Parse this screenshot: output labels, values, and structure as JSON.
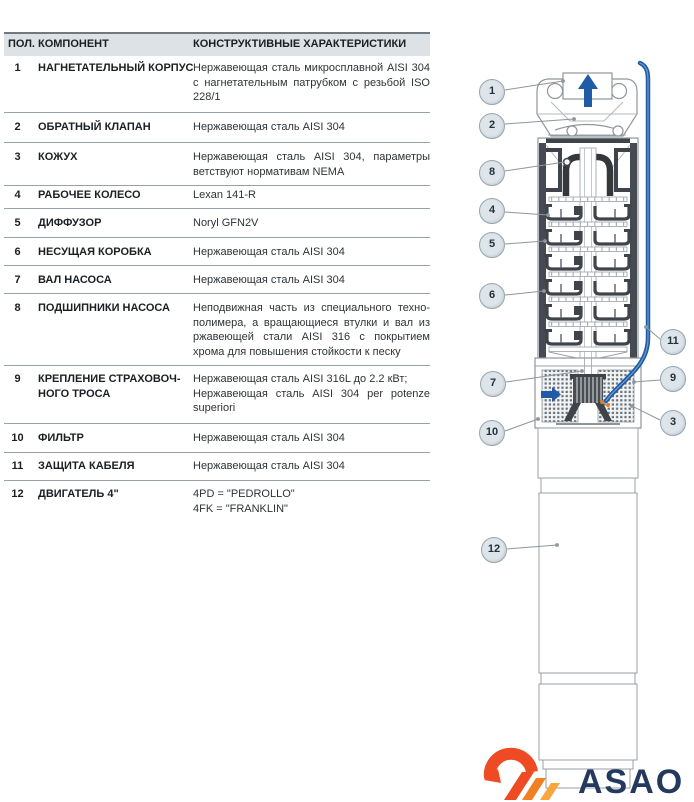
{
  "table": {
    "headers": {
      "pos": "ПОЛ.",
      "component": "КОМПОНЕНТ",
      "characteristics": "КОНСТРУКТИВНЫЕ ХАРАКТЕРИСТИКИ"
    },
    "rows": [
      {
        "num": "1",
        "component_lines": [
          "НАГНЕТАТЕЛЬНЫЙ КОРПУС"
        ],
        "spec_lines": [
          "Нержавеющая сталь микросплавной AISI 304",
          "с нагнетательным патрубком с резьбой ISO",
          "228/1"
        ]
      },
      {
        "num": "2",
        "component_lines": [
          "ОБРАТНЫЙ КЛАПАН"
        ],
        "spec_lines": [
          "Нержавеющая сталь AISI 304"
        ]
      },
      {
        "num": "3",
        "component_lines": [
          "КОЖУХ"
        ],
        "spec_lines": [
          "Нержавеющая сталь AISI 304, параметры соот-",
          "ветствуют нормативам NEMA"
        ]
      },
      {
        "num": "4",
        "component_lines": [
          "РАБОЧЕЕ КОЛЕСО"
        ],
        "spec_lines": [
          "Lexan 141-R"
        ]
      },
      {
        "num": "5",
        "component_lines": [
          "ДИФФУЗОР"
        ],
        "spec_lines": [
          "Noryl GFN2V"
        ]
      },
      {
        "num": "6",
        "component_lines": [
          "НЕСУЩАЯ КОРОБКА"
        ],
        "spec_lines": [
          "Нержавеющая сталь AISI 304"
        ]
      },
      {
        "num": "7",
        "component_lines": [
          "ВАЛ НАСОСА"
        ],
        "spec_lines": [
          "Нержавеющая сталь AISI 304"
        ]
      },
      {
        "num": "8",
        "component_lines": [
          "ПОДШИПНИКИ НАСОСА"
        ],
        "spec_lines": [
          "Неподвижная часть из специального техно-",
          "полимера, а вращающиеся втулки и вал из не-",
          "ржавеющей стали AISI 316 с покрытием окисью",
          "хрома для повышения стойкости к песку"
        ]
      },
      {
        "num": "9",
        "component_lines": [
          "КРЕПЛЕНИЕ СТРАХОВОЧ-",
          "НОГО ТРОСА"
        ],
        "spec_lines": [
          "Нержавеющая сталь AISI 316L до 2.2 кВт;",
          "Нержавеющая сталь AISI 304 per potenze",
          "superiori"
        ]
      },
      {
        "num": "10",
        "component_lines": [
          "ФИЛЬТР"
        ],
        "spec_lines": [
          "Нержавеющая сталь AISI 304"
        ]
      },
      {
        "num": "11",
        "component_lines": [
          "ЗАЩИТА КАБЕЛЯ"
        ],
        "spec_lines": [
          "Нержавеющая сталь AISI 304"
        ]
      },
      {
        "num": "12",
        "component_lines": [
          "ДВИГАТЕЛЬ 4\""
        ],
        "spec_lines": [
          "4PD = \"PEDROLLO\"",
          "4FK = \"FRANKLIN\""
        ]
      }
    ]
  },
  "diagram": {
    "callouts": {
      "c1": "1",
      "c2": "2",
      "c3": "3",
      "c4": "4",
      "c5": "5",
      "c6": "6",
      "c7": "7",
      "c8": "8",
      "c9": "9",
      "c10": "10",
      "c11": "11",
      "c12": "12"
    }
  },
  "logo": {
    "text": "ASAO"
  },
  "colors": {
    "accent_blue": "#1f5ca5",
    "drawing_dark": "#3f444a",
    "drawing_gray": "#8f979c",
    "header_band": "#dce2e5",
    "callout_fill": "#dee5ea",
    "logo_red": "#ee4a23",
    "logo_orange": "#f08122",
    "logo_light_orange": "#f8a63c",
    "logo_navy": "#233a5e"
  }
}
